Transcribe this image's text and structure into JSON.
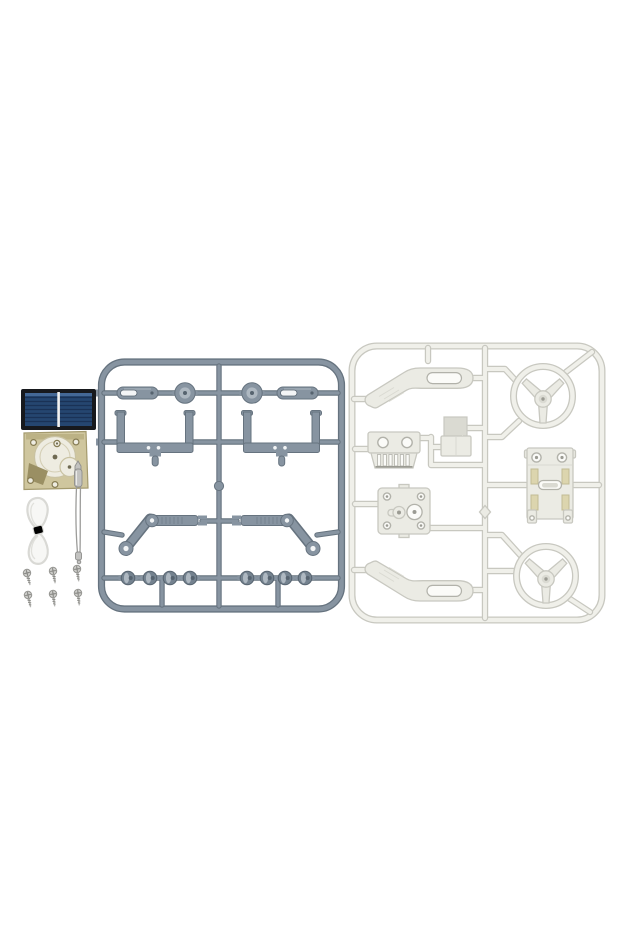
{
  "image": {
    "type": "product-photo",
    "subject": "Unassembled solar-powered DIY toy car kit: two plastic part sprues, solar panel, motor gearbox, tubing, flexible shaft and screws on a white background"
  },
  "palette": {
    "bg": "#ffffff",
    "sprue_gray": "#8794a1",
    "sprue_edge": "#66737f",
    "sprue_light": "#aeb8c1",
    "sprue_mid": "#74828f",
    "sprue_deep": "#56636f",
    "slot_white": "#f3f5f6",
    "white_tube_outline": "#c8c8c0",
    "white_tube_light": "#f0f0ea",
    "white_part_fill": "#ebebe4",
    "white_slot": "#fbfbf8",
    "white_shade": "#dadad2",
    "white_ring_edge": "#b2b2aa",
    "white_dot": "#9b9b93",
    "chassis_slot_tint": "#dcd5ae",
    "chassis_slot_edge": "#c2bb94",
    "solar_frame": "#17191d",
    "solar_cell": "#254670",
    "solar_stripe": "#1a3256",
    "solar_highlight": "#4f74a3",
    "solar_divider": "#f2f2f0",
    "motor_plate": "#cfc69e",
    "motor_plate_edge": "#a49a6e",
    "motor_strip": "#b9ae80",
    "motor_gear": "#eeece1",
    "motor_gear_edge": "#c9c2a2",
    "motor_wedge": "#9a8f63",
    "motor_hole_edge": "#857b52",
    "motor_dot": "#6f6a52",
    "metal_light": "#c2c2c0",
    "metal_dark": "#8e8e8c",
    "wire": "#9c9c9a",
    "tube_fill": "#f7f7f5",
    "tube_edge": "#d9d9d5",
    "tube_knot": "#ececе8",
    "screw_head": "#cfcfcc",
    "screw_edge": "#93938f",
    "screw_shank": "#b7b7b4",
    "screw_thread": "#878783"
  },
  "components": {
    "solar_panel": {
      "name": "solar panel",
      "cells": 2
    },
    "motor_gearbox": {
      "name": "motor gearbox"
    },
    "tubing": {
      "name": "clear plastic tubing tied in a bow"
    },
    "flexible_shaft": {
      "name": "flexible metal shaft"
    },
    "screws": {
      "name": "mounting screws",
      "count": 6,
      "layout": "2 rows x 3 columns"
    },
    "gray_sprue": {
      "name": "gray parts sprue (runner A)",
      "parts": [
        {
          "part": "slotted bar",
          "count": 2
        },
        {
          "part": "round grommet disc",
          "count": 2
        },
        {
          "part": "U-shaped bracket",
          "count": 2
        },
        {
          "part": "lever arm assembly",
          "count": 2
        },
        {
          "part": "wheel hub",
          "count": 8
        }
      ]
    },
    "white_sprue": {
      "name": "white parts sprue (runner B)",
      "parts": [
        {
          "part": "steering wheel",
          "count": 2
        },
        {
          "part": "curved suspension arm",
          "count": 2
        },
        {
          "part": "gear rack plate",
          "count": 1
        },
        {
          "part": "battery box",
          "count": 1
        },
        {
          "part": "gearbox plate",
          "count": 1
        },
        {
          "part": "chassis plate",
          "count": 1
        }
      ]
    }
  }
}
